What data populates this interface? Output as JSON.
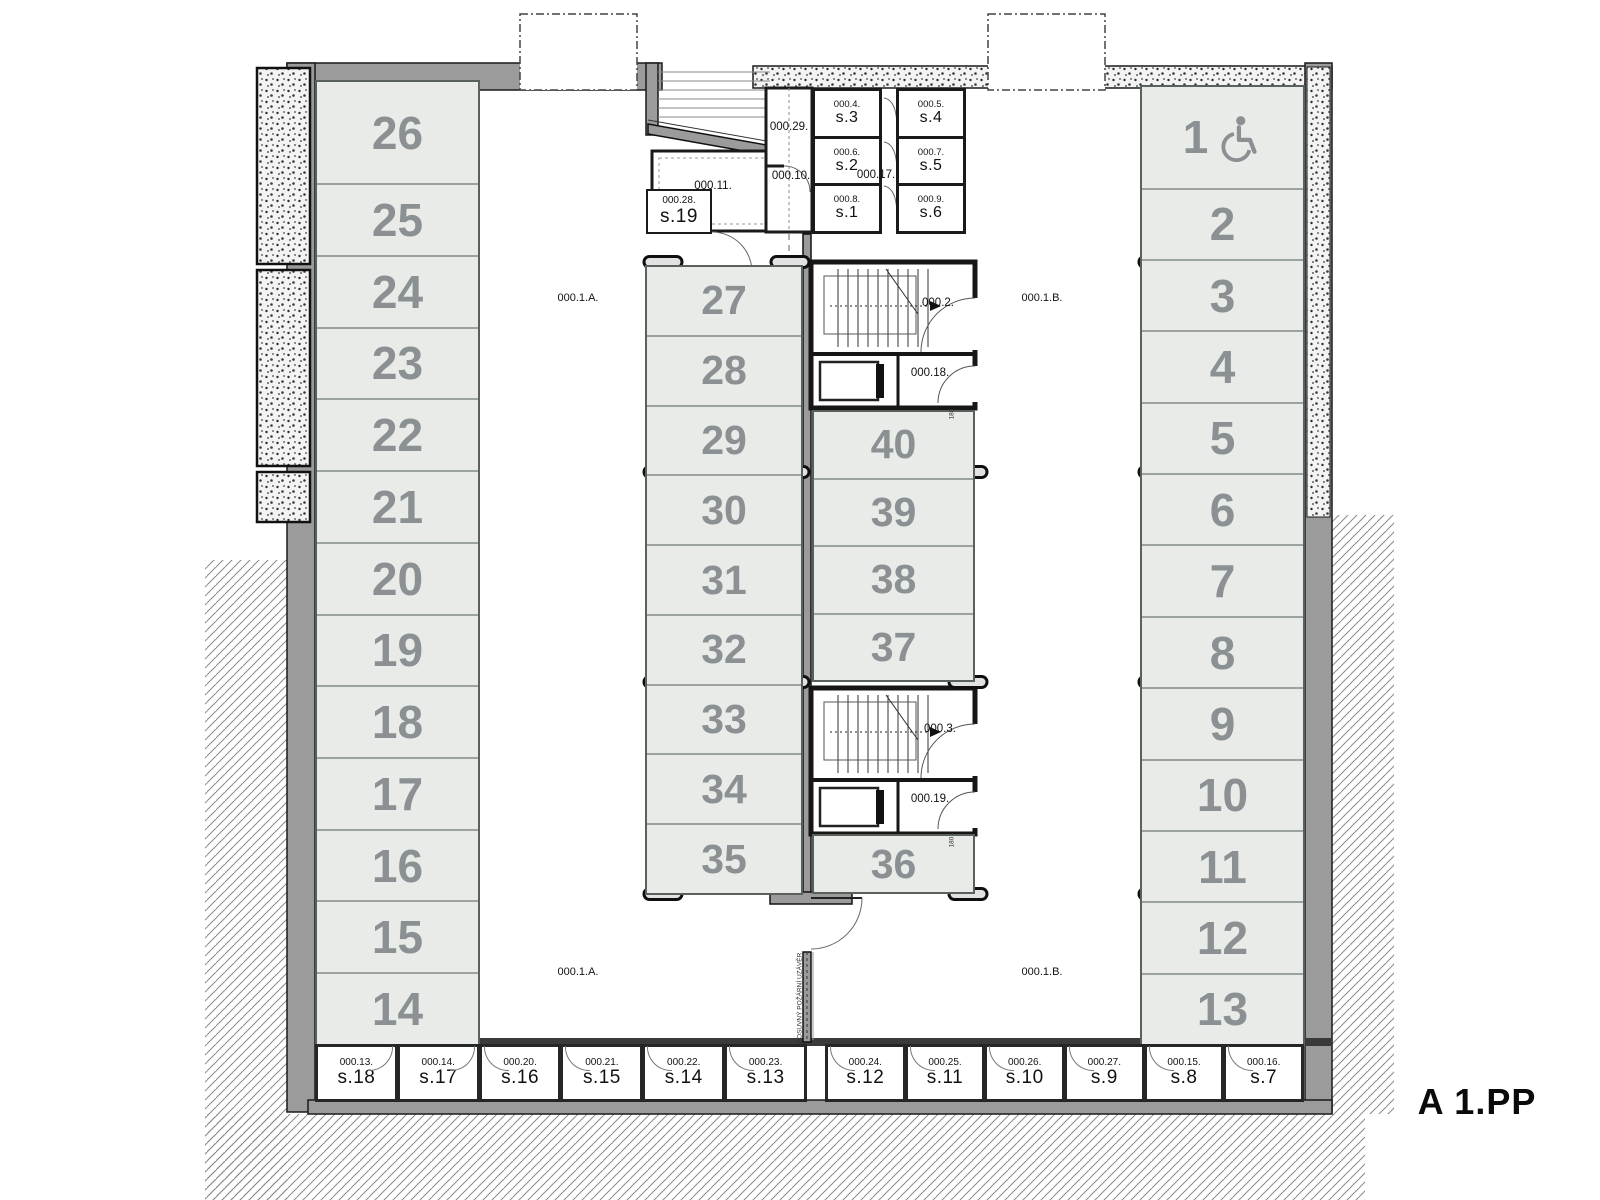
{
  "title": "A 1.PP",
  "zones": {
    "a": "000.1.A.",
    "b": "000.1.B."
  },
  "parking": {
    "left_column": [
      "26",
      "25",
      "24",
      "23",
      "22",
      "21",
      "20",
      "19",
      "18",
      "17",
      "16",
      "15",
      "14"
    ],
    "right_column": [
      "1",
      "2",
      "3",
      "4",
      "5",
      "6",
      "7",
      "8",
      "9",
      "10",
      "11",
      "12",
      "13"
    ],
    "mid_left_column": [
      "27",
      "28",
      "29",
      "30",
      "31",
      "32",
      "33",
      "34",
      "35"
    ],
    "mid_right_column": [
      "40",
      "39",
      "38",
      "37"
    ],
    "mid_right_single": "36",
    "accessible_space": "1"
  },
  "stairs": {
    "upper": "000.2.",
    "lower": "000.3."
  },
  "elevator_lobbies": {
    "upper": "000.18.",
    "lower": "000.19."
  },
  "top_rooms": {
    "ramp_room": "000.29.",
    "corridor_left": "000.10.",
    "corridor_cells": "000.17.",
    "tech_room": "000.11."
  },
  "storage_top_left": [
    {
      "code": "000.4.",
      "name": "s.3"
    },
    {
      "code": "000.6.",
      "name": "s.2"
    },
    {
      "code": "000.8.",
      "name": "s.1"
    }
  ],
  "storage_top_right": [
    {
      "code": "000.5.",
      "name": "s.4"
    },
    {
      "code": "000.7.",
      "name": "s.5"
    },
    {
      "code": "000.9.",
      "name": "s.6"
    }
  ],
  "storage_s19": {
    "code": "000.28.",
    "name": "s.19"
  },
  "storage_bottom_left": [
    {
      "code": "000.13.",
      "name": "s.18"
    },
    {
      "code": "000.14.",
      "name": "s.17"
    },
    {
      "code": "000.20.",
      "name": "s.16"
    },
    {
      "code": "000.21.",
      "name": "s.15"
    },
    {
      "code": "000.22.",
      "name": "s.14"
    },
    {
      "code": "000.23.",
      "name": "s.13"
    }
  ],
  "storage_bottom_right": [
    {
      "code": "000.24.",
      "name": "s.12"
    },
    {
      "code": "000.25.",
      "name": "s.11"
    },
    {
      "code": "000.26.",
      "name": "s.10"
    },
    {
      "code": "000.27.",
      "name": "s.9"
    },
    {
      "code": "000.15.",
      "name": "s.8"
    },
    {
      "code": "000.16.",
      "name": "s.7"
    }
  ],
  "annotations": {
    "fire_shutter": "POSUVNÝ POŽÁRNÍ UZÁVĚR",
    "door_dim": "180"
  },
  "icons": {
    "accessible": "wheelchair-icon"
  },
  "colors": {
    "stall_fill": "#e8ebe8",
    "stall_number": "#8b9093",
    "wall": "#9b9b9b",
    "wall_line": "#1a1a1a",
    "title": "#0a0a0a"
  }
}
